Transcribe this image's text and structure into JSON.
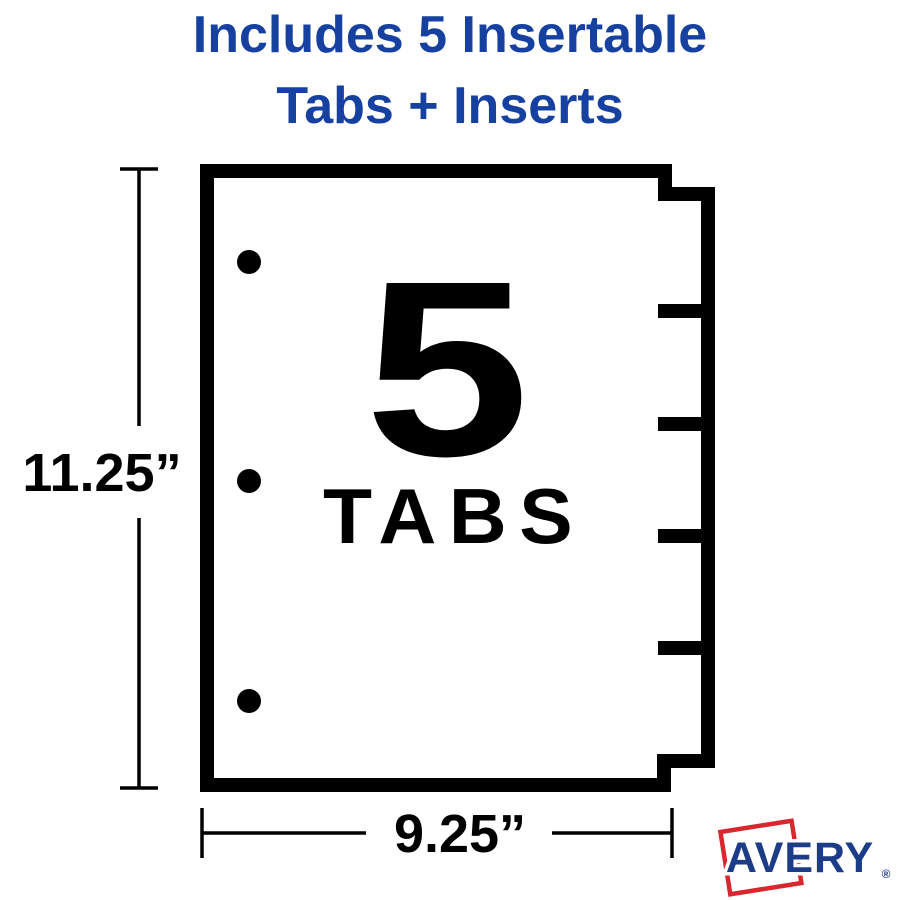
{
  "heading": {
    "line1": "Includes 5 Insertable",
    "line2": "Tabs + Inserts",
    "color": "#1641a0"
  },
  "diagram": {
    "tab_count_number": "5",
    "tab_count_label": "TABS",
    "height_dimension": "11.25”",
    "width_dimension": "9.25”",
    "num_tabs": 5,
    "num_holes": 3,
    "line_color": "#000000",
    "sheet_color": "#ffffff"
  },
  "logo": {
    "brand": "AVERY",
    "registered_mark": "®",
    "blue": "#1d3c87",
    "red": "#d8272e"
  }
}
